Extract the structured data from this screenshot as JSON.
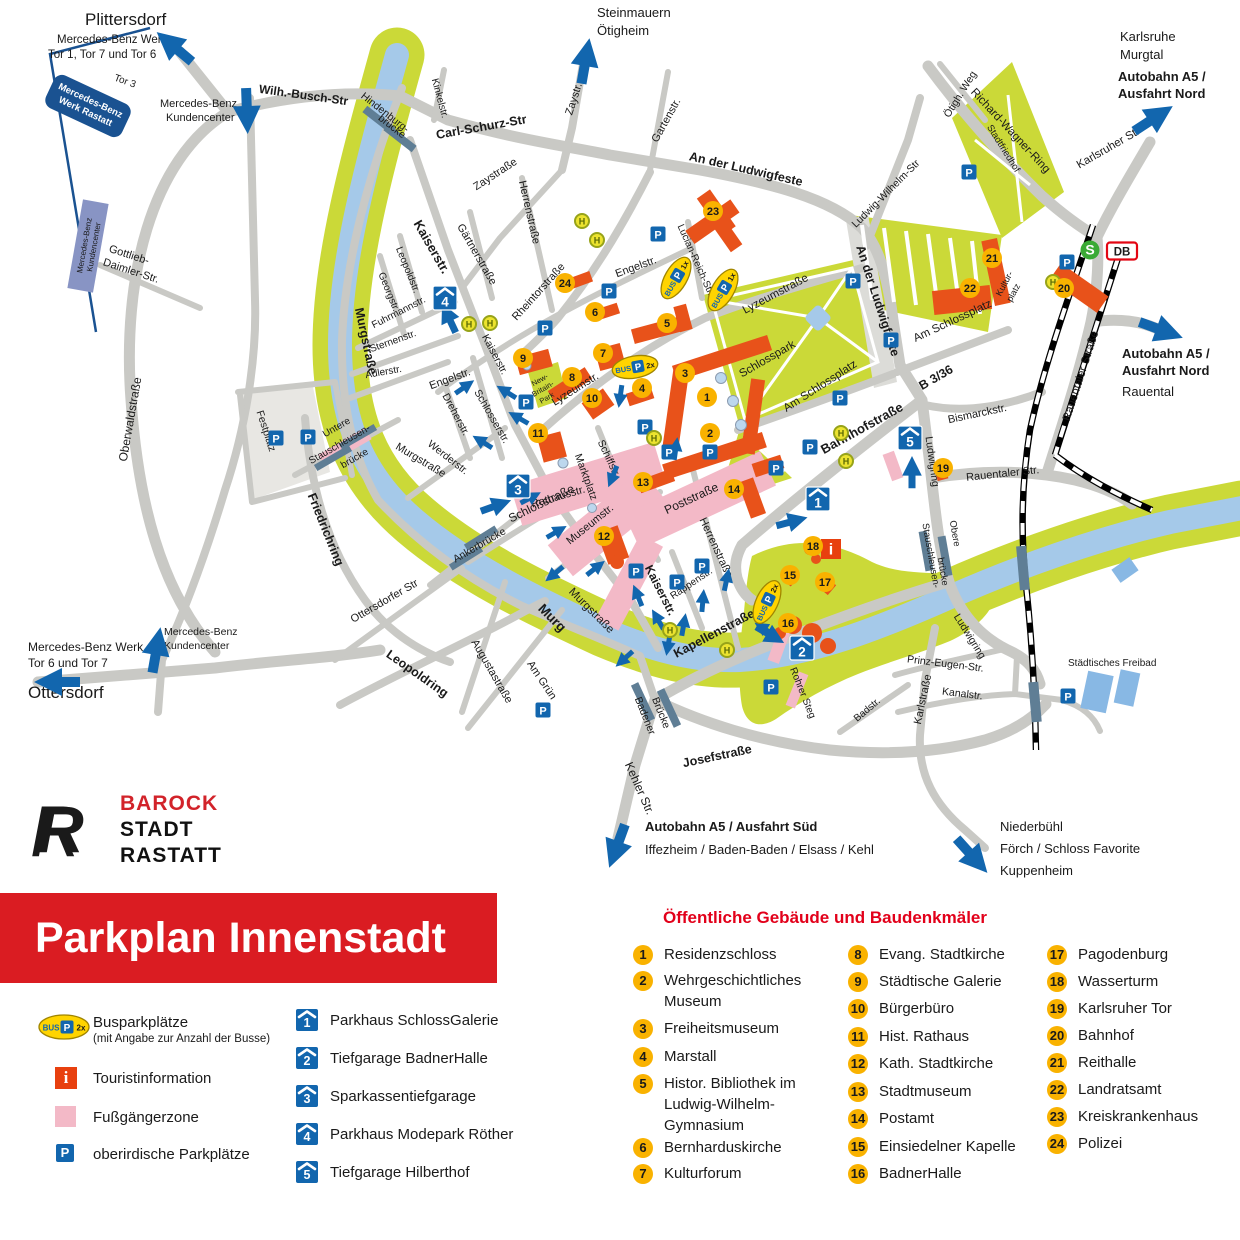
{
  "banner": {
    "title": "Parkplan Innenstadt"
  },
  "logo": {
    "name1": "BAROCK",
    "name2": "STADT",
    "name3": "RASTATT",
    "mark": "R"
  },
  "legend": {
    "bus": {
      "label": "Busparkplätze",
      "sub": "(mit Angabe zur Anzahl der Busse)"
    },
    "tourist": {
      "label": "Touristinformation"
    },
    "pedestrian": {
      "label": "Fußgängerzone"
    },
    "parking": {
      "label": "oberirdische Parkplätze"
    }
  },
  "garages": {
    "items": [
      {
        "num": "1",
        "label": "Parkhaus SchlossGalerie"
      },
      {
        "num": "2",
        "label": "Tiefgarage BadnerHalle"
      },
      {
        "num": "3",
        "label": "Sparkassentiefgarage"
      },
      {
        "num": "4",
        "label": "Parkhaus Modepark Röther"
      },
      {
        "num": "5",
        "label": "Tiefgarage Hilberthof"
      }
    ]
  },
  "buildings": {
    "heading": "Öffentliche Gebäude und Baudenkmäler",
    "items": [
      {
        "num": "1",
        "label": "Residenzschloss"
      },
      {
        "num": "2",
        "label": "Wehrgeschichtliches Museum"
      },
      {
        "num": "3",
        "label": "Freiheitsmuseum"
      },
      {
        "num": "4",
        "label": "Marstall"
      },
      {
        "num": "5",
        "label": "Histor. Bibliothek im Ludwig-Wilhelm-Gymnasium"
      },
      {
        "num": "6",
        "label": "Bernharduskirche"
      },
      {
        "num": "7",
        "label": "Kulturforum"
      },
      {
        "num": "8",
        "label": "Evang. Stadtkirche"
      },
      {
        "num": "9",
        "label": "Städtische Galerie"
      },
      {
        "num": "10",
        "label": "Bürgerbüro"
      },
      {
        "num": "11",
        "label": "Hist. Rathaus"
      },
      {
        "num": "12",
        "label": "Kath. Stadtkirche"
      },
      {
        "num": "13",
        "label": "Stadtmuseum"
      },
      {
        "num": "14",
        "label": "Postamt"
      },
      {
        "num": "15",
        "label": "Einsiedelner Kapelle"
      },
      {
        "num": "16",
        "label": "BadnerHalle"
      },
      {
        "num": "17",
        "label": "Pagodenburg"
      },
      {
        "num": "18",
        "label": "Wasserturm"
      },
      {
        "num": "19",
        "label": "Karlsruher Tor"
      },
      {
        "num": "20",
        "label": "Bahnhof"
      },
      {
        "num": "21",
        "label": "Reithalle"
      },
      {
        "num": "22",
        "label": "Landratsamt"
      },
      {
        "num": "23",
        "label": "Kreiskrankenhaus"
      },
      {
        "num": "24",
        "label": "Polizei"
      }
    ]
  },
  "map": {
    "letters": {
      "p": "P",
      "h": "H",
      "i": "i",
      "s": "S",
      "db": "DB"
    },
    "bus": {
      "bus": "BUS",
      "p": "P",
      "x1": "1x",
      "x2": "2x"
    },
    "destinations": {
      "plittersdorf": "Plittersdorf",
      "mb_tor_nord_l1": "Mercedes-Benz Werk",
      "mb_tor_nord_l2": "Tor 1, Tor 7 und Tor 6",
      "mb_kc_l1": "Mercedes-Benz",
      "mb_kc_l2": "Kundencenter",
      "steinmauern": "Steinmauern",
      "oetigheim": "Ötigheim",
      "karlsruhe": "Karlsruhe",
      "murgtal": "Murgtal",
      "a5": "Autobahn A5 /",
      "ausfahrt_nord": "Ausfahrt Nord",
      "rauental": "Rauental",
      "mb_tor_sued_l1": "Mercedes-Benz Werk",
      "mb_tor_sued_l2": "Tor 6 und Tor 7",
      "ottersdorf": "Ottersdorf",
      "a5_sued": "Autobahn A5 / Ausfahrt Süd",
      "a5_sued_sub": "Iffezheim / Baden-Baden / Elsass / Kehl",
      "niederbuehl": "Niederbühl",
      "foerch": "Förch / Schloss Favorite",
      "kuppenheim": "Kuppenheim",
      "tor3": "Tor 3",
      "mb_werk_l1": "Mercedes-Benz",
      "mb_werk_l2": "Werk Rastatt"
    },
    "streets": {
      "wilh_busch": "Wilh.-Busch-Str",
      "carl_schurz": "Carl-Schurz-Str",
      "kinkelstr": "Kinkelstr.",
      "zaystr": "Zaystr.",
      "zaystrasse": "Zaystraße",
      "gartenstr": "Gartenstr.",
      "an_der_ludwigfeste": "An der Ludwigfeste",
      "ludwig_wilhelm": "Ludwig-Wilhelm-Str",
      "richard_wagner": "Richard-Wagner-Ring",
      "oetigheimer_weg": "Ötigh. Weg",
      "karlsruher_str": "Karlsruher Str",
      "herrenstrasse": "Herrenstraße",
      "gaertnerstrasse": "Gärtnerstraße",
      "rheintorstrasse": "Rheintorstraße",
      "kaiserstr": "Kaiserstr.",
      "leopoldstr": "Leopoldstr.",
      "georgstr": "Georgstr.",
      "fuhrmannstr": "Fuhrmannstr.",
      "sternenstr": "Sternenstr.",
      "adlerstr": "Adlerstr.",
      "murgstrasse": "Murgstraße",
      "engelstr": "Engelstr.",
      "dreherstr": "Dreherstr.",
      "schlosserstr": "Schlosserstr.",
      "werderstr": "Werderstr.",
      "lucian_reich": "Lucian-Reich-Str.",
      "lyzeumstr": "Lyzeumstr.",
      "lyzeumstrasse": "Lyzeumstraße",
      "schlossstrasse": "Schloßstraße",
      "rathausstr": "Rathausstr.",
      "marktplatz": "Marktplatz",
      "schiffstr": "Schiffstr.",
      "museumstr": "Museumstr.",
      "poststrasse": "Poststraße",
      "rappenstr": "Rappenstr.",
      "kapellenstrasse": "Kapellenstraße",
      "am_gruen": "Am Grün",
      "augustastrasse": "Augustastraße",
      "leopoldring": "Leopoldring",
      "friedrichring": "Friedrichring",
      "ottersdorfer_str": "Ottersdorfer Str",
      "oberwaldstrasse": "Oberwaldstraße",
      "gottlieb1": "Gottlieb-",
      "gottlieb2": "Daimler-Str.",
      "kehler_str": "Kehler Str.",
      "josefstrasse": "Josefstraße",
      "karlstrasse": "Karlstraße",
      "badstr": "Badstr.",
      "prinz_eugen": "Prinz-Eugen-Str.",
      "kanalstr": "Kanalstr.",
      "ludwigring": "Ludwigring",
      "bahnhofstrasse": "Bahnhofstraße",
      "b336": "B 3/36",
      "bismarckstr": "Bismarckstr.",
      "rauentaler_str": "Rauentaler Str.",
      "rauentaler_strasse": "Rauentaler Straße",
      "am_schlossplatz": "Am Schlossplatz"
    },
    "places": {
      "schlosspark": "Schlosspark",
      "stadtfriedhof": "Stadtfriedhof",
      "festplatz": "Festplatz",
      "kulturplatz_l1": "Kultur-",
      "kulturplatz_l2": "platz",
      "newbritain_l1": "New-",
      "newbritain_l2": "Britain-",
      "newbritain_l3": "Park",
      "freibad": "Städtisches Freibad",
      "murg": "Murg"
    },
    "bridges": {
      "hindenburg_l1": "Hindenburg-",
      "hindenburg_l2": "brücke",
      "ankerbruecke": "Ankerbrücke",
      "untere_l1": "Untere",
      "untere_l2": "Stauschleusen-",
      "untere_l3": "brücke",
      "obere_l1": "Obere",
      "obere_l2": "Stauschleusen-",
      "obere_l3": "brücke",
      "badener_l1": "Badener",
      "badener_l2": "Brücke",
      "rohrer": "Rohrer Steg"
    }
  }
}
